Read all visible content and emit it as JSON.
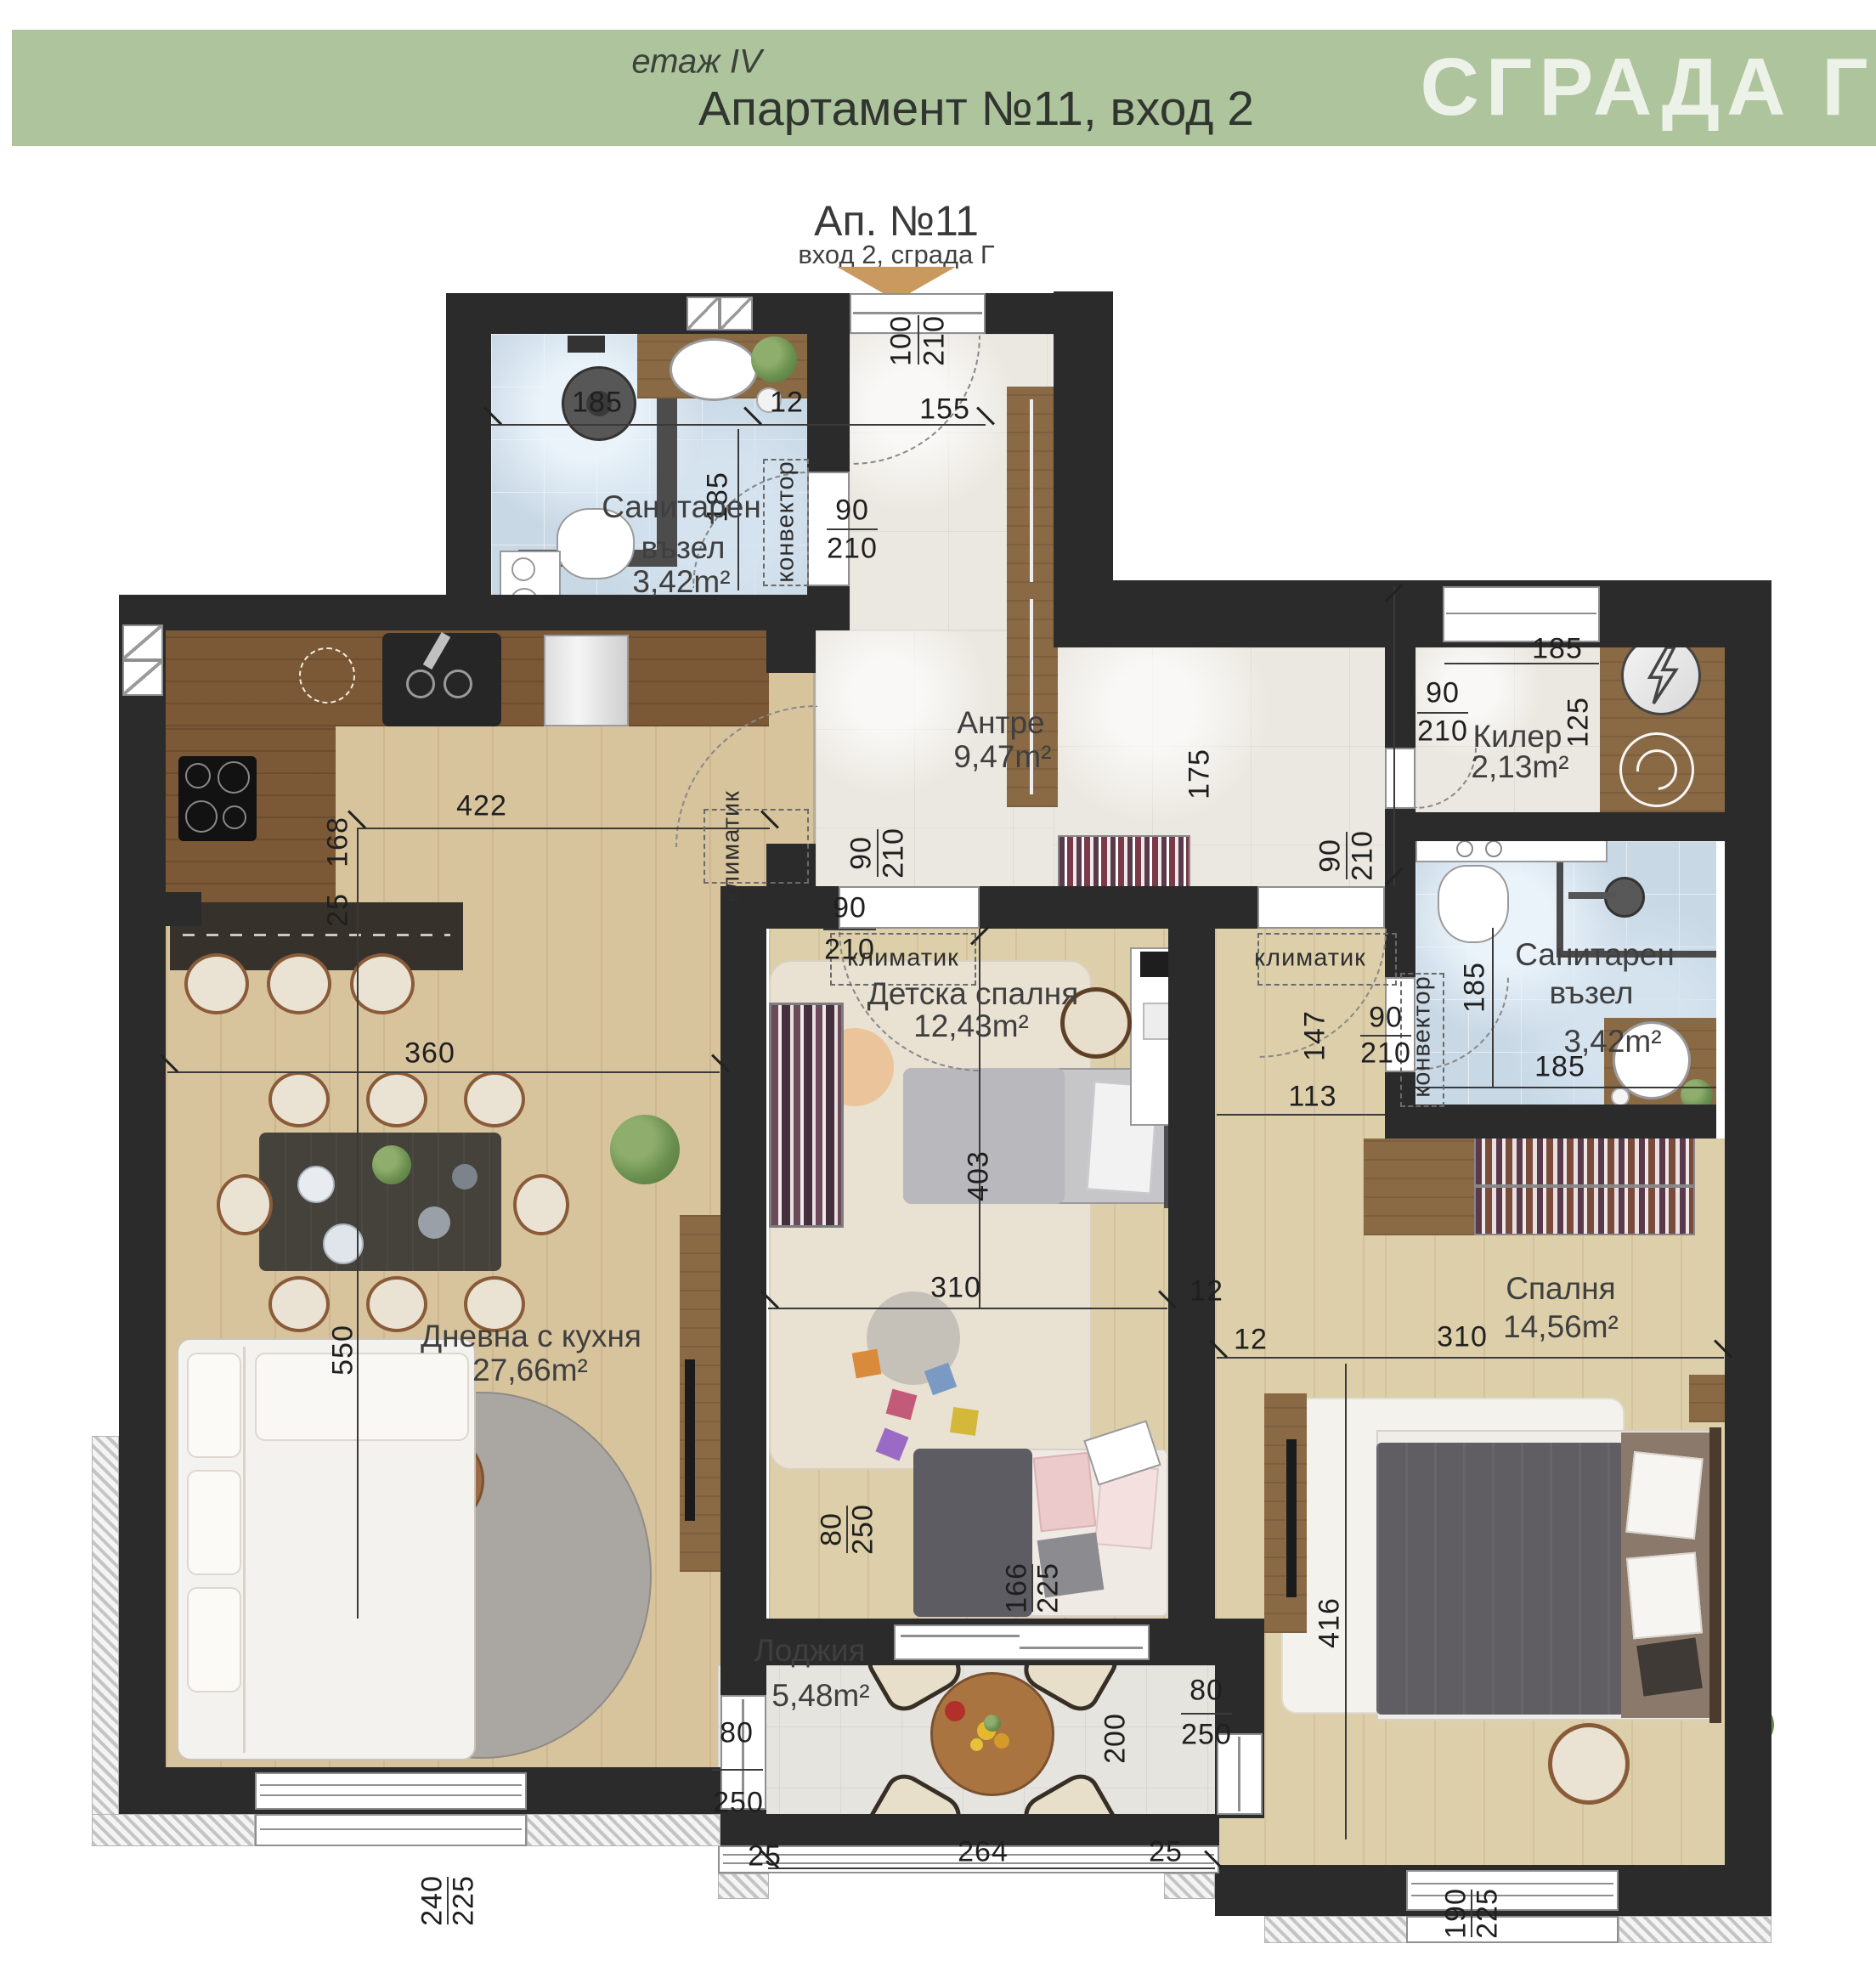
{
  "header": {
    "floor": "етаж IV",
    "title": "Апартамент №11, вход 2",
    "building": "СГРАДА Г"
  },
  "entrance": {
    "title": "Ап. №11",
    "subtitle": "вход 2, сграда Г"
  },
  "rooms": {
    "bath1": {
      "l1": "Санитарен",
      "l2": "възел",
      "area": "3,42m²"
    },
    "entry": {
      "name": "Антре",
      "area": "9,47m²"
    },
    "storage": {
      "name": "Килер",
      "area": "2,13m²"
    },
    "bath2": {
      "l1": "Санитарен",
      "l2": "възел",
      "area": "3,42m²"
    },
    "kids": {
      "name": "Детска спалня",
      "area": "12,43m²"
    },
    "living": {
      "name": "Дневна с кухня",
      "area": "27,66m²"
    },
    "bedroom": {
      "name": "Спалня",
      "area": "14,56m²"
    },
    "loggia": {
      "name": "Лоджия",
      "area": "5,48m²"
    }
  },
  "annotations": {
    "ac": "климатик",
    "conv": "конвектор"
  },
  "dims": {
    "entry_door_w": "100",
    "entry_door_h": "210",
    "entry_top": "155",
    "bath1_w": "185",
    "bath1_gap": "12",
    "bath1_h": "185",
    "bath1_door_w": "90",
    "bath1_door_h": "210",
    "kitchen_w": "422",
    "kitchen_d": "168",
    "bar_d": "25",
    "living_w": "360",
    "living_d": "550",
    "pass_w": "90",
    "pass_h": "210",
    "kids_door_w": "90",
    "kids_door_h": "210",
    "kids_len": "403",
    "kids_w": "310",
    "kids_wall": "12",
    "entry_len": "175",
    "storage_win": "185",
    "storage_door_w": "90",
    "storage_door_h": "210",
    "storage_d": "125",
    "bed_door_w": "90",
    "bed_door_h": "210",
    "hall_d": "147",
    "hall_w": "113",
    "bath2_h": "185",
    "bath2_w": "185",
    "bath2_door_w": "90",
    "bath2_door_h": "210",
    "bed_w": "310",
    "bed_wall": "12",
    "bed_len": "416",
    "kids_log_w": "80",
    "kids_log_h": "250",
    "kids_win_w": "166",
    "kids_win_h": "225",
    "log_left_w": "80",
    "log_left_h": "250",
    "log_right_w": "80",
    "log_right_h": "250",
    "log_d": "200",
    "log_w": "264",
    "log_wall_l": "25",
    "log_wall_r": "25",
    "living_win_w": "240",
    "living_win_h": "225",
    "bed_win_w": "190",
    "bed_win_h": "225"
  }
}
